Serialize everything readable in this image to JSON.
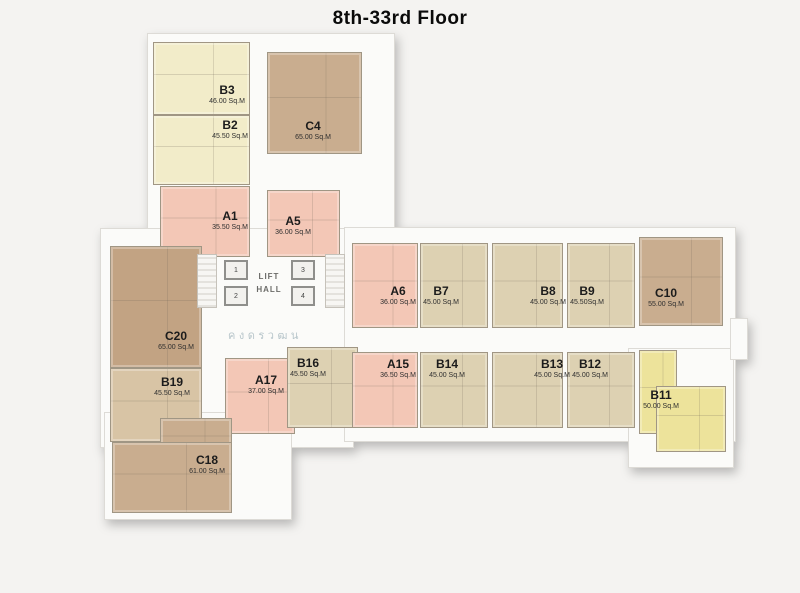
{
  "title": "8th-33rd Floor",
  "watermark": {
    "text": "ค ง ด ร ว ฒ น"
  },
  "lift": {
    "line1": "LIFT",
    "line2": "HALL",
    "cars": [
      "1",
      "2",
      "3",
      "4"
    ]
  },
  "units": [
    {
      "name": "B3",
      "area": "46.00 Sq.M"
    },
    {
      "name": "B2",
      "area": "45.50 Sq.M"
    },
    {
      "name": "C4",
      "area": "65.00 Sq.M"
    },
    {
      "name": "A1",
      "area": "35.50 Sq.M"
    },
    {
      "name": "A5",
      "area": "36.00 Sq.M"
    },
    {
      "name": "A6",
      "area": "36.00 Sq.M"
    },
    {
      "name": "B7",
      "area": "45.00 Sq.M"
    },
    {
      "name": "B8",
      "area": "45.00 Sq.M"
    },
    {
      "name": "B9",
      "area": "45.50Sq.M"
    },
    {
      "name": "C10",
      "area": "55.00 Sq.M"
    },
    {
      "name": "C20",
      "area": "65.00 Sq.M"
    },
    {
      "name": "B19",
      "area": "45.50 Sq.M"
    },
    {
      "name": "A17",
      "area": "37.00 Sq.M"
    },
    {
      "name": "C18",
      "area": "61.00 Sq.M"
    },
    {
      "name": "B16",
      "area": "45.50 Sq.M"
    },
    {
      "name": "A15",
      "area": "36.50 Sq.M"
    },
    {
      "name": "B14",
      "area": "45.00 Sq.M"
    },
    {
      "name": "B13",
      "area": "45.00 Sq.M"
    },
    {
      "name": "B12",
      "area": "45.00 Sq.M"
    },
    {
      "name": "B11",
      "area": "50.00 Sq.M"
    }
  ],
  "colors": {
    "cream": "#f2ecc9",
    "pink": "#f3c7b6",
    "beige": "#ddd1b2",
    "tan": "#c9ad8f",
    "c20_brown": "#c2a383",
    "b19_brown": "#d8c4a5",
    "yellow": "#ede39b",
    "background": "#f4f3f1",
    "wall": "#a09684",
    "title_text": "#0a0a0a"
  }
}
